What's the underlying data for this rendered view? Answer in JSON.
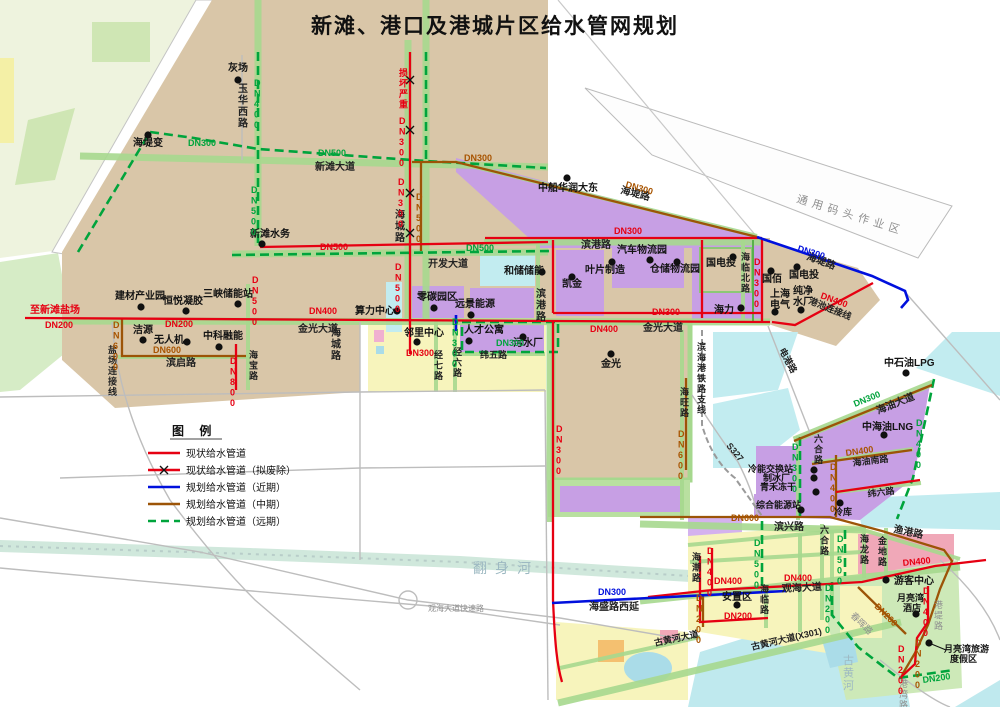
{
  "title": "新滩、港口及港城片区给水管网规划",
  "legend": {
    "title": "图 例",
    "items": [
      {
        "label": "现状给水管道",
        "style": "red-solid"
      },
      {
        "label": "现状给水管道（拟废除）",
        "style": "red-x"
      },
      {
        "label": "规划给水管道（近期）",
        "style": "blue-solid"
      },
      {
        "label": "规划给水管道（中期）",
        "style": "brown-solid"
      },
      {
        "label": "规划给水管道（远期）",
        "style": "green-dashed"
      }
    ]
  },
  "palette": {
    "pipe_existing": "#e60012",
    "pipe_near_term": "#0010dd",
    "pipe_mid_term": "#9c5407",
    "pipe_far_term": "#00a43c",
    "land_tan": "#d9c6a8",
    "industrial_purple": "#c79fe4",
    "residential_yellow": "#f7f4bc",
    "water_cyan": "#c2ecf0",
    "green_belt": "#a6d88e"
  },
  "map": {
    "labels": [
      {
        "t": "灰场",
        "x": 228,
        "y": 71,
        "c": "k"
      },
      {
        "t": "海堤变",
        "x": 133,
        "y": 146,
        "c": "k"
      },
      {
        "t": "新滩水务",
        "x": 250,
        "y": 237,
        "c": "k"
      },
      {
        "t": "中船华润大东",
        "x": 538,
        "y": 191,
        "c": "k"
      },
      {
        "t": "建材产业园",
        "x": 115,
        "y": 299,
        "c": "k"
      },
      {
        "t": "恒悦凝胶",
        "x": 163,
        "y": 304,
        "c": "k"
      },
      {
        "t": "三峡储能站",
        "x": 203,
        "y": 297,
        "c": "k"
      },
      {
        "t": "洁源",
        "x": 133,
        "y": 333,
        "c": "k"
      },
      {
        "t": "无人机",
        "x": 154,
        "y": 343,
        "c": "k"
      },
      {
        "t": "中科融能",
        "x": 203,
        "y": 339,
        "c": "k"
      },
      {
        "t": "算力中心",
        "x": 355,
        "y": 314,
        "c": "k"
      },
      {
        "t": "零碳园区",
        "x": 417,
        "y": 300,
        "c": "k"
      },
      {
        "t": "远景能源",
        "x": 455,
        "y": 307,
        "c": "k"
      },
      {
        "t": "邻里中心",
        "x": 404,
        "y": 336,
        "c": "k"
      },
      {
        "t": "人才公寓",
        "x": 464,
        "y": 333,
        "c": "k"
      },
      {
        "t": "污水厂",
        "x": 513,
        "y": 346,
        "c": "k"
      },
      {
        "t": "和储储能",
        "x": 504,
        "y": 274,
        "c": "k"
      },
      {
        "t": "凯金",
        "x": 562,
        "y": 287,
        "c": "k"
      },
      {
        "t": "叶片制造",
        "x": 585,
        "y": 273,
        "c": "k"
      },
      {
        "t": "汽车物流园",
        "x": 617,
        "y": 253,
        "c": "k"
      },
      {
        "t": "仓储物流园",
        "x": 650,
        "y": 272,
        "c": "k"
      },
      {
        "t": "国电投",
        "x": 706,
        "y": 266,
        "c": "k"
      },
      {
        "t": "国佰",
        "x": 762,
        "y": 282,
        "c": "k"
      },
      {
        "t": "国电投",
        "x": 789,
        "y": 278,
        "c": "k"
      },
      {
        "t": "上海",
        "x": 770,
        "y": 297,
        "c": "k"
      },
      {
        "t": "电气",
        "x": 770,
        "y": 308,
        "c": "k"
      },
      {
        "t": "纯净",
        "x": 793,
        "y": 294,
        "c": "k"
      },
      {
        "t": "水厂",
        "x": 793,
        "y": 305,
        "c": "k"
      },
      {
        "t": "海力",
        "x": 714,
        "y": 313,
        "c": "k"
      },
      {
        "t": "金光",
        "x": 601,
        "y": 367,
        "c": "k"
      },
      {
        "t": "中石油LPG",
        "x": 884,
        "y": 366,
        "c": "k"
      },
      {
        "t": "中海油LNG",
        "x": 862,
        "y": 430,
        "c": "k"
      },
      {
        "t": "冷能交换站",
        "x": 748,
        "y": 472,
        "c": "k",
        "fs": 9
      },
      {
        "t": "制冰厂",
        "x": 763,
        "y": 481,
        "c": "k",
        "fs": 9
      },
      {
        "t": "青禾冻干",
        "x": 760,
        "y": 490,
        "c": "k",
        "fs": 9
      },
      {
        "t": "综合能源站",
        "x": 756,
        "y": 508,
        "c": "k",
        "fs": 9
      },
      {
        "t": "冷库",
        "x": 834,
        "y": 515,
        "c": "k",
        "fs": 9
      },
      {
        "t": "游客中心",
        "x": 894,
        "y": 584,
        "c": "k"
      },
      {
        "t": "安置区",
        "x": 722,
        "y": 600,
        "c": "k"
      },
      {
        "t": "月亮湾",
        "x": 897,
        "y": 601,
        "c": "k",
        "fs": 9
      },
      {
        "t": "酒店",
        "x": 903,
        "y": 611,
        "c": "k",
        "fs": 9
      },
      {
        "t": "月亮湾旅游",
        "x": 944,
        "y": 652,
        "c": "k",
        "fs": 9
      },
      {
        "t": "度假区",
        "x": 950,
        "y": 662,
        "c": "k",
        "fs": 9
      },
      {
        "t": "玉华西路",
        "x": 238,
        "y": 92,
        "c": "ro",
        "v": 1
      },
      {
        "t": "新滩大道",
        "x": 315,
        "y": 170,
        "c": "ro"
      },
      {
        "t": "海城路",
        "x": 395,
        "y": 218,
        "c": "ro",
        "v": 1
      },
      {
        "t": "海城路",
        "x": 331,
        "y": 336,
        "c": "ro",
        "v": 1
      },
      {
        "t": "开发大道",
        "x": 428,
        "y": 267,
        "c": "ro"
      },
      {
        "t": "滨港路",
        "x": 581,
        "y": 248,
        "c": "ro"
      },
      {
        "t": "滨港路",
        "x": 536,
        "y": 297,
        "c": "ro",
        "v": 1
      },
      {
        "t": "海堤路",
        "x": 620,
        "y": 193,
        "c": "ro",
        "r": 14
      },
      {
        "t": "海堤路",
        "x": 806,
        "y": 259,
        "c": "ro",
        "r": 20
      },
      {
        "t": "海临北路",
        "x": 741,
        "y": 260,
        "c": "ro",
        "v": 1,
        "fs": 9
      },
      {
        "t": "港池连接线",
        "x": 808,
        "y": 303,
        "c": "ro",
        "r": 22,
        "fs": 9
      },
      {
        "t": "金光大道",
        "x": 298,
        "y": 332,
        "c": "ro"
      },
      {
        "t": "金光大道",
        "x": 643,
        "y": 331,
        "c": "ro"
      },
      {
        "t": "滨启路",
        "x": 166,
        "y": 366,
        "c": "ro"
      },
      {
        "t": "盐场连接线",
        "x": 108,
        "y": 353,
        "c": "ro",
        "v": 1,
        "fs": 9
      },
      {
        "t": "海宝路",
        "x": 249,
        "y": 358,
        "c": "ro",
        "v": 1,
        "fs": 9
      },
      {
        "t": "经七路",
        "x": 434,
        "y": 358,
        "c": "ro",
        "v": 1,
        "fs": 9
      },
      {
        "t": "经六路",
        "x": 453,
        "y": 355,
        "c": "ro",
        "v": 1,
        "fs": 9
      },
      {
        "t": "纬五路",
        "x": 480,
        "y": 358,
        "c": "ro",
        "fs": 9
      },
      {
        "t": "海旺路",
        "x": 680,
        "y": 395,
        "c": "ro",
        "v": 1,
        "fs": 9
      },
      {
        "t": "滨海港铁路支线",
        "x": 697,
        "y": 350,
        "c": "ro",
        "v": 1,
        "fs": 9
      },
      {
        "t": "电港路",
        "x": 779,
        "y": 350,
        "c": "ro",
        "r": 62,
        "fs": 9
      },
      {
        "t": "S327",
        "x": 726,
        "y": 446,
        "c": "ro",
        "r": 50,
        "fs": 9
      },
      {
        "t": "海油大道",
        "x": 878,
        "y": 414,
        "c": "ro",
        "r": -22
      },
      {
        "t": "海油南路",
        "x": 853,
        "y": 466,
        "c": "ro",
        "r": -7,
        "fs": 9
      },
      {
        "t": "六合路",
        "x": 814,
        "y": 442,
        "c": "ro",
        "v": 1,
        "fs": 9
      },
      {
        "t": "六合路",
        "x": 820,
        "y": 533,
        "c": "ro",
        "v": 1,
        "fs": 9
      },
      {
        "t": "纬六路",
        "x": 868,
        "y": 497,
        "c": "ro",
        "r": -7,
        "fs": 9
      },
      {
        "t": "滨兴路",
        "x": 774,
        "y": 530,
        "c": "ro"
      },
      {
        "t": "渔港路",
        "x": 893,
        "y": 532,
        "c": "ro",
        "r": 12
      },
      {
        "t": "海潮路",
        "x": 692,
        "y": 560,
        "c": "ro",
        "v": 1,
        "fs": 9
      },
      {
        "t": "海临路",
        "x": 760,
        "y": 592,
        "c": "ro",
        "v": 1,
        "fs": 9
      },
      {
        "t": "海龙路",
        "x": 860,
        "y": 542,
        "c": "ro",
        "v": 1,
        "fs": 9
      },
      {
        "t": "金地路",
        "x": 878,
        "y": 544,
        "c": "ro",
        "v": 1,
        "fs": 9
      },
      {
        "t": "观海大道",
        "x": 782,
        "y": 592,
        "c": "ro",
        "r": -3
      },
      {
        "t": "古黄河大道",
        "x": 655,
        "y": 646,
        "c": "ro",
        "r": -12,
        "fs": 9
      },
      {
        "t": "古黄河大道(X301)",
        "x": 752,
        "y": 650,
        "c": "ro",
        "r": -13,
        "fs": 9
      },
      {
        "t": "海盛路西延",
        "x": 589,
        "y": 610,
        "c": "ro"
      },
      {
        "t": "春晖路",
        "x": 850,
        "y": 616,
        "c": "gy",
        "r": 45,
        "fs": 9
      },
      {
        "t": "港堤路",
        "x": 934,
        "y": 608,
        "c": "gy",
        "v": 1,
        "fs": 9
      },
      {
        "t": "港湾路",
        "x": 899,
        "y": 687,
        "c": "gy",
        "v": 1,
        "fs": 9
      },
      {
        "t": "通用码头作业区",
        "x": 796,
        "y": 202,
        "c": "gy",
        "r": 17,
        "fs": 11,
        "ls": 5
      },
      {
        "t": "观海大道快速路",
        "x": 428,
        "y": 611,
        "c": "gy",
        "fs": 8
      },
      {
        "t": "翻身河",
        "x": 473,
        "y": 573,
        "c": "wm",
        "fs": 14,
        "ls": 8
      },
      {
        "t": "古黄河",
        "x": 843,
        "y": 664,
        "c": "wm",
        "v": 1,
        "fs": 11
      },
      {
        "t": "损坏严重",
        "x": 399,
        "y": 76,
        "c": "rd",
        "v": 1,
        "fs": 9
      },
      {
        "t": "DN300",
        "x": 399,
        "y": 124,
        "c": "rd",
        "v": 1,
        "fs": 9
      },
      {
        "t": "DN300",
        "x": 398,
        "y": 185,
        "c": "rd",
        "v": 1,
        "fs": 9
      },
      {
        "t": "DN500",
        "x": 320,
        "y": 250,
        "c": "rd",
        "fs": 9
      },
      {
        "t": "DN500",
        "x": 395,
        "y": 270,
        "c": "rd",
        "v": 1,
        "fs": 9
      },
      {
        "t": "DN500",
        "x": 252,
        "y": 283,
        "c": "rd",
        "v": 1,
        "fs": 9
      },
      {
        "t": "至新滩盐场",
        "x": 30,
        "y": 313,
        "c": "rd"
      },
      {
        "t": "DN200",
        "x": 45,
        "y": 328,
        "c": "rd",
        "fs": 9
      },
      {
        "t": "DN200",
        "x": 165,
        "y": 327,
        "c": "rd",
        "fs": 9
      },
      {
        "t": "DN800",
        "x": 230,
        "y": 364,
        "c": "rd",
        "v": 1,
        "fs": 9
      },
      {
        "t": "DN400",
        "x": 309,
        "y": 314,
        "c": "rd",
        "fs": 9
      },
      {
        "t": "DN300",
        "x": 652,
        "y": 315,
        "c": "rd",
        "fs": 9
      },
      {
        "t": "DN300",
        "x": 614,
        "y": 234,
        "c": "rd",
        "fs": 9
      },
      {
        "t": "DN300",
        "x": 754,
        "y": 265,
        "c": "rd",
        "v": 1,
        "fs": 9
      },
      {
        "t": "DN400",
        "x": 820,
        "y": 298,
        "c": "rd",
        "r": 20,
        "fs": 9
      },
      {
        "t": "DN400",
        "x": 590,
        "y": 332,
        "c": "rd",
        "fs": 9
      },
      {
        "t": "DN300",
        "x": 556,
        "y": 432,
        "c": "rd",
        "v": 1,
        "fs": 9
      },
      {
        "t": "DN300",
        "x": 406,
        "y": 356,
        "c": "rd",
        "fs": 9
      },
      {
        "t": "DN400",
        "x": 707,
        "y": 554,
        "c": "rd",
        "v": 1,
        "fs": 9
      },
      {
        "t": "DN400",
        "x": 714,
        "y": 584,
        "c": "rd",
        "fs": 9
      },
      {
        "t": "DN400",
        "x": 784,
        "y": 581,
        "c": "rd",
        "fs": 9
      },
      {
        "t": "DN400",
        "x": 903,
        "y": 566,
        "c": "rd",
        "r": -6,
        "fs": 9
      },
      {
        "t": "DN200",
        "x": 724,
        "y": 619,
        "c": "rd",
        "fs": 9
      },
      {
        "t": "DN400",
        "x": 923,
        "y": 594,
        "c": "rd",
        "v": 1,
        "fs": 9
      },
      {
        "t": "DN200",
        "x": 898,
        "y": 652,
        "c": "rd",
        "v": 1,
        "fs": 9
      },
      {
        "t": "DN300",
        "x": 464,
        "y": 161,
        "c": "br",
        "fs": 9
      },
      {
        "t": "DN300",
        "x": 625,
        "y": 187,
        "c": "br",
        "r": 16,
        "fs": 9
      },
      {
        "t": "DN500",
        "x": 416,
        "y": 200,
        "c": "br",
        "v": 1,
        "fs": 9
      },
      {
        "t": "DN600",
        "x": 113,
        "y": 328,
        "c": "br",
        "v": 1,
        "fs": 9
      },
      {
        "t": "DN600",
        "x": 153,
        "y": 353,
        "c": "br",
        "fs": 9
      },
      {
        "t": "DN600",
        "x": 678,
        "y": 437,
        "c": "br",
        "v": 1,
        "fs": 9
      },
      {
        "t": "DN400",
        "x": 830,
        "y": 470,
        "c": "br",
        "v": 1,
        "fs": 9
      },
      {
        "t": "DN400",
        "x": 846,
        "y": 456,
        "c": "br",
        "r": -8,
        "fs": 9
      },
      {
        "t": "DN600",
        "x": 731,
        "y": 521,
        "c": "br",
        "fs": 9
      },
      {
        "t": "DN200",
        "x": 874,
        "y": 607,
        "c": "br",
        "r": 45,
        "fs": 9
      },
      {
        "t": "DN200",
        "x": 915,
        "y": 646,
        "c": "br",
        "v": 1,
        "fs": 9
      },
      {
        "t": "DN200",
        "x": 696,
        "y": 601,
        "c": "br",
        "v": 1,
        "fs": 9
      },
      {
        "t": "DN400",
        "x": 254,
        "y": 86,
        "c": "gn",
        "v": 1,
        "fs": 9
      },
      {
        "t": "DN300",
        "x": 188,
        "y": 146,
        "c": "gn",
        "fs": 9
      },
      {
        "t": "DN500",
        "x": 318,
        "y": 156,
        "c": "gn",
        "fs": 9
      },
      {
        "t": "DN500",
        "x": 251,
        "y": 193,
        "c": "gn",
        "v": 1,
        "fs": 9
      },
      {
        "t": "DN500",
        "x": 466,
        "y": 251,
        "c": "gn",
        "fs": 9
      },
      {
        "t": "DN300",
        "x": 452,
        "y": 325,
        "c": "gn",
        "v": 1,
        "fs": 9
      },
      {
        "t": "DN300",
        "x": 496,
        "y": 346,
        "c": "gn",
        "fs": 9
      },
      {
        "t": "DN300",
        "x": 792,
        "y": 450,
        "c": "gn",
        "v": 1,
        "fs": 9
      },
      {
        "t": "DN400",
        "x": 916,
        "y": 426,
        "c": "gn",
        "v": 1,
        "fs": 9
      },
      {
        "t": "DN300",
        "x": 855,
        "y": 407,
        "c": "gn",
        "r": -22,
        "fs": 9
      },
      {
        "t": "DN500",
        "x": 754,
        "y": 546,
        "c": "gn",
        "v": 1,
        "fs": 9
      },
      {
        "t": "DN500",
        "x": 837,
        "y": 542,
        "c": "gn",
        "v": 1,
        "fs": 9
      },
      {
        "t": "DN200",
        "x": 825,
        "y": 591,
        "c": "gn",
        "v": 1,
        "fs": 9
      },
      {
        "t": "DN200",
        "x": 923,
        "y": 683,
        "c": "gn",
        "r": -8,
        "fs": 9
      },
      {
        "t": "DN300",
        "x": 797,
        "y": 251,
        "c": "bl",
        "r": 17,
        "fs": 9
      },
      {
        "t": "DN300",
        "x": 598,
        "y": 595,
        "c": "bl",
        "fs": 9
      }
    ],
    "dots": [
      [
        238,
        80
      ],
      [
        148,
        135
      ],
      [
        262,
        244
      ],
      [
        567,
        178
      ],
      [
        141,
        307
      ],
      [
        186,
        311
      ],
      [
        238,
        304
      ],
      [
        143,
        340
      ],
      [
        187,
        342
      ],
      [
        219,
        347
      ],
      [
        397,
        311
      ],
      [
        434,
        308
      ],
      [
        471,
        315
      ],
      [
        417,
        342
      ],
      [
        469,
        341
      ],
      [
        523,
        337
      ],
      [
        542,
        272
      ],
      [
        572,
        277
      ],
      [
        612,
        262
      ],
      [
        650,
        260
      ],
      [
        677,
        262
      ],
      [
        733,
        257
      ],
      [
        771,
        271
      ],
      [
        797,
        267
      ],
      [
        775,
        312
      ],
      [
        801,
        310
      ],
      [
        741,
        308
      ],
      [
        611,
        354
      ],
      [
        906,
        373
      ],
      [
        884,
        435
      ],
      [
        814,
        470
      ],
      [
        814,
        478
      ],
      [
        816,
        492
      ],
      [
        801,
        510
      ],
      [
        840,
        503
      ],
      [
        886,
        580
      ],
      [
        737,
        605
      ],
      [
        916,
        614
      ],
      [
        929,
        643
      ]
    ],
    "xmarks": [
      [
        410,
        80
      ],
      [
        410,
        130
      ],
      [
        410,
        193
      ],
      [
        410,
        233
      ]
    ]
  }
}
